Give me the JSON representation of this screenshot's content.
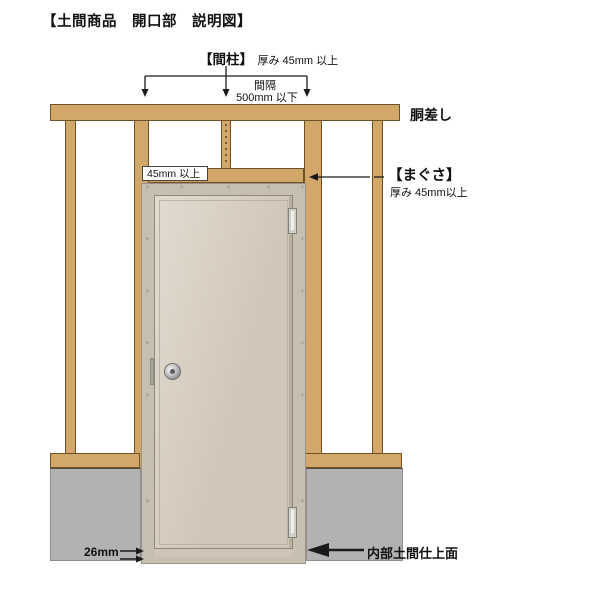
{
  "title": "【土間商品　開口部　説明図】",
  "labels": {
    "mabashira": "【間柱】",
    "mabashira_detail": "厚み 45mm 以上",
    "spacing_line1": "間隔",
    "spacing_line2": "500mm 以下",
    "dosashi": "胴差し",
    "magusa": "【まぐさ】",
    "magusa_detail": "厚み 45mm以上",
    "header_min_width": "45mm 以上",
    "bottom_gap": "26mm",
    "floor_surface": "内部土間仕上面"
  },
  "colors": {
    "wood": "#d1a86a",
    "wood_border": "#6e5226",
    "foundation_gray": "#b2b2b2",
    "door_frame": "#c8bfb3",
    "door_panel": "#d9cfc0",
    "annotation": "#111111",
    "background": "#ffffff"
  }
}
